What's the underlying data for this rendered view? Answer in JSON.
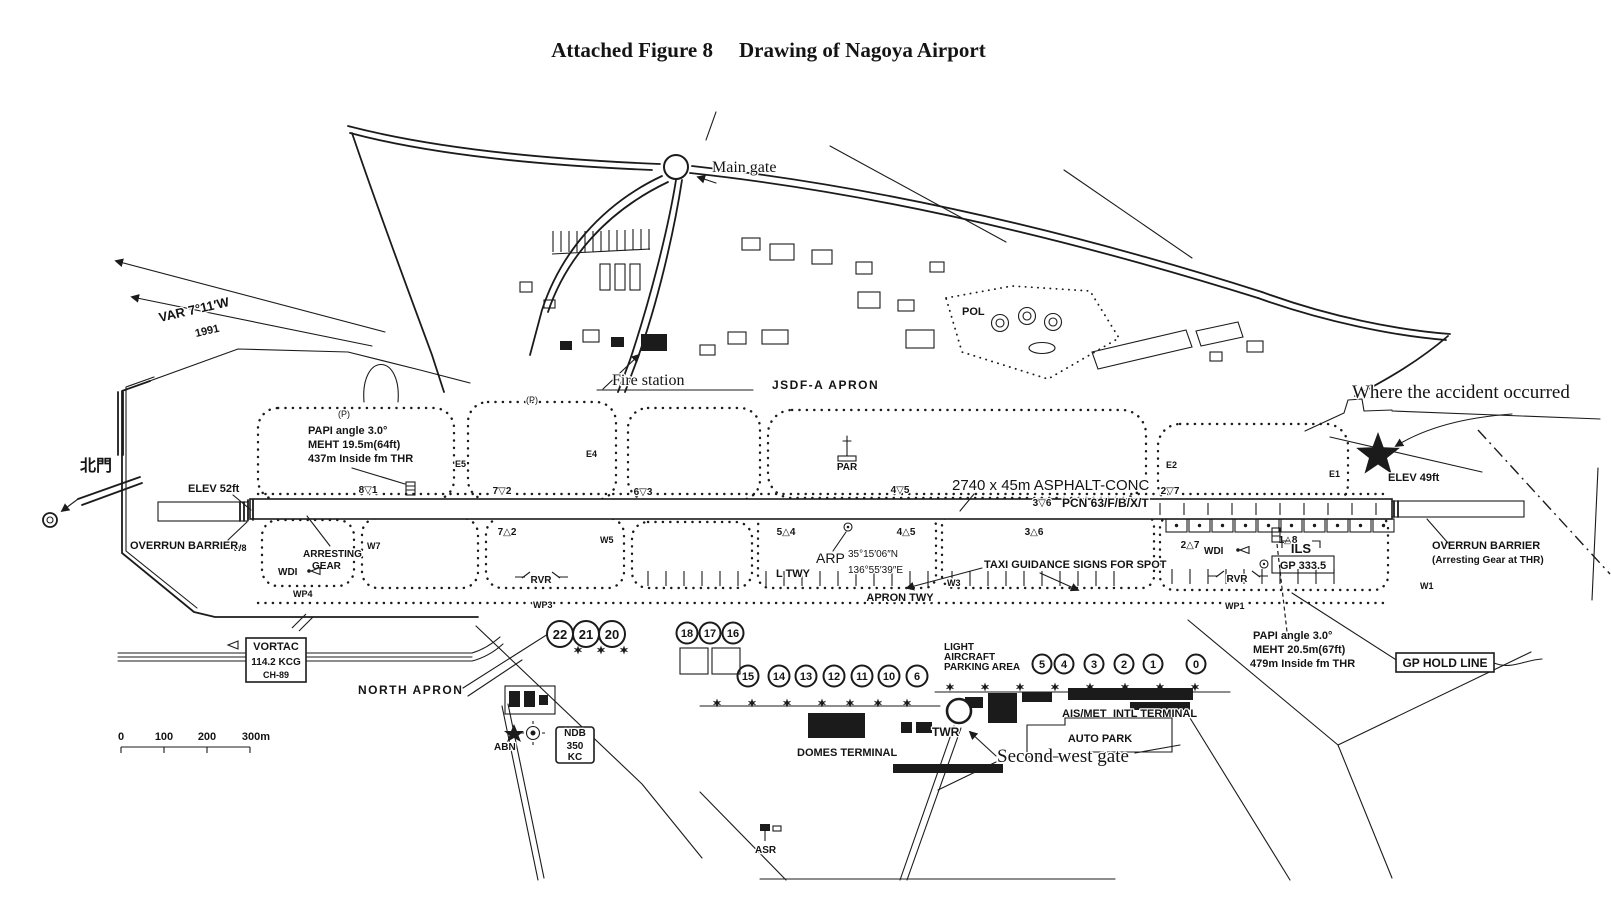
{
  "colors": {
    "ink": "#1b1b1b",
    "paper": "#ffffff"
  },
  "title": {
    "figure_label": "Attached Figure 8",
    "figure_title": "Drawing of Nagoya Airport"
  },
  "annotations": {
    "main_gate": "Main gate",
    "north_gate": "北門",
    "second_west_gate": "Second west gate",
    "fire_station": "Fire station",
    "accident": "Where the accident occurred",
    "var_line1": "VAR 7°11′W",
    "var_line2": "1991"
  },
  "airfield": {
    "jsdf_apron": "JSDF-A  APRON",
    "pol": "POL",
    "par": "PAR",
    "runway_dim": "2740 x 45m ASPHALT-CONC",
    "runway_pcn": "PCN 63/F/B/X/T",
    "elev_west": "ELEV 52ft",
    "elev_east": "ELEV 49ft",
    "overrun_west": "OVERRUN BARRIER",
    "overrun_east_1": "OVERRUN BARRIER",
    "overrun_east_2": "(Arresting Gear at THR)",
    "arresting_1": "ARRESTING",
    "arresting_2": "GEAR",
    "wdi_west": "WDI",
    "wdi_east": "WDI",
    "rvr_west": "RVR",
    "rvr_east": "RVR",
    "l_twy": "L TWY",
    "apron_twy": "APRON TWY",
    "taxi_guidance": "TAXI GUIDANCE SIGNS FOR SPOT",
    "north_apron": "NORTH APRON",
    "light_1": "LIGHT",
    "light_2": "AIRCRAFT",
    "light_3": "PARKING AREA",
    "ais_met": "AIS/MET",
    "intl_terminal": "INTL TERMINAL",
    "domes_terminal": "DOMES TERMINAL",
    "auto_park": "AUTO PARK",
    "twr": "TWR",
    "asr": "ASR",
    "abn": "ABN",
    "gp_hold_line": "GP HOLD LINE",
    "p_west": "(P)",
    "p_mid": "(P)"
  },
  "arp": {
    "label": "ARP",
    "lat": "35°15′06″N",
    "lon": "136°55′39″E"
  },
  "ils": {
    "label": "ILS",
    "gp": "GP 333.5"
  },
  "papi_west": {
    "line1": "PAPI angle 3.0°",
    "line2": "MEHT 19.5m(64ft)",
    "line3": "437m Inside fm THR"
  },
  "papi_east": {
    "line1": "PAPI angle 3.0°",
    "line2": "MEHT 20.5m(67ft)",
    "line3": "479m Inside fm THR"
  },
  "vortac": {
    "name": "VORTAC",
    "freq": "114.2 KCG",
    "channel": "CH-89"
  },
  "ndb": {
    "name": "NDB",
    "freq": "350",
    "unit": "KC"
  },
  "spots": {
    "row_a": [
      "22",
      "21",
      "20"
    ],
    "row_b": [
      "18",
      "17",
      "16"
    ],
    "row_c": [
      "15",
      "14",
      "13",
      "12",
      "11",
      "10",
      "6"
    ],
    "row_d": [
      "5",
      "4",
      "3",
      "2",
      "1",
      "0"
    ]
  },
  "markers": {
    "top": [
      "8▽1",
      "7▽2",
      "6▽3",
      "4▽5",
      "3▽6",
      "2▽7"
    ],
    "bottom": [
      "7△2",
      "5△4",
      "4△5",
      "3△6",
      "2△7",
      "1△8"
    ],
    "east": [
      "E5",
      "E4",
      "E2",
      "E1"
    ],
    "west": [
      "W8",
      "W7",
      "W5",
      "W3",
      "W1"
    ],
    "wp": [
      "WP4",
      "WP3",
      "WP1"
    ]
  },
  "scale_bar": {
    "ticks": [
      "0",
      "100",
      "200",
      "300m"
    ]
  }
}
